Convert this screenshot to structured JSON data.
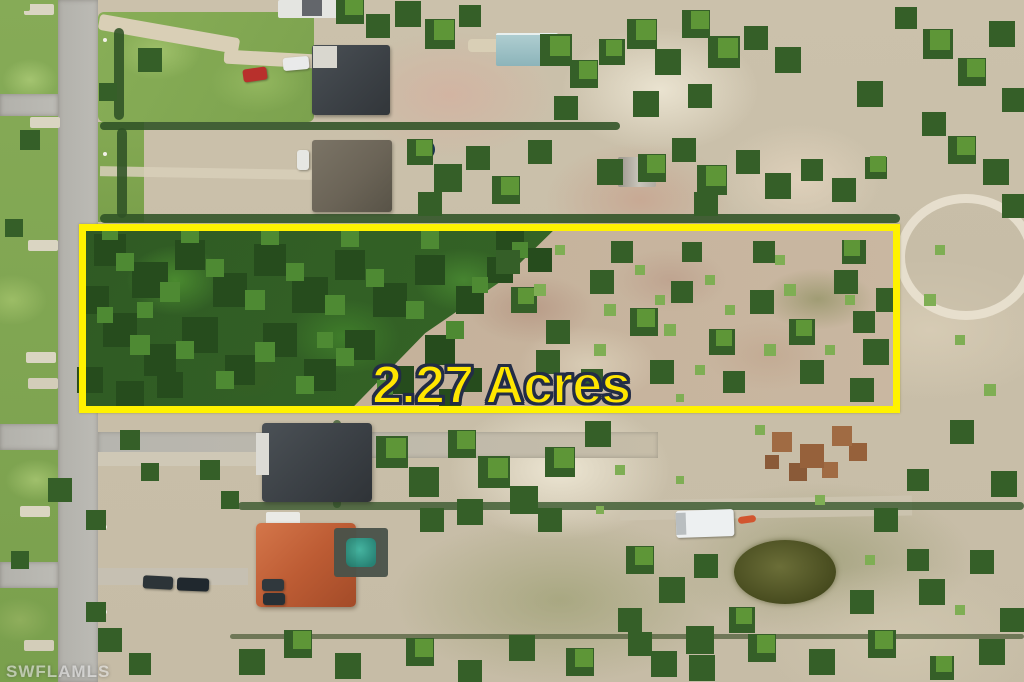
{
  "overlay": {
    "acreage_label": "2.27 Acres",
    "watermark": "SWFLAMLS",
    "highlight_box_color": "#FFF200",
    "acreage_text_color": "#FFE600",
    "acreage_outline_color": "#222C46"
  }
}
